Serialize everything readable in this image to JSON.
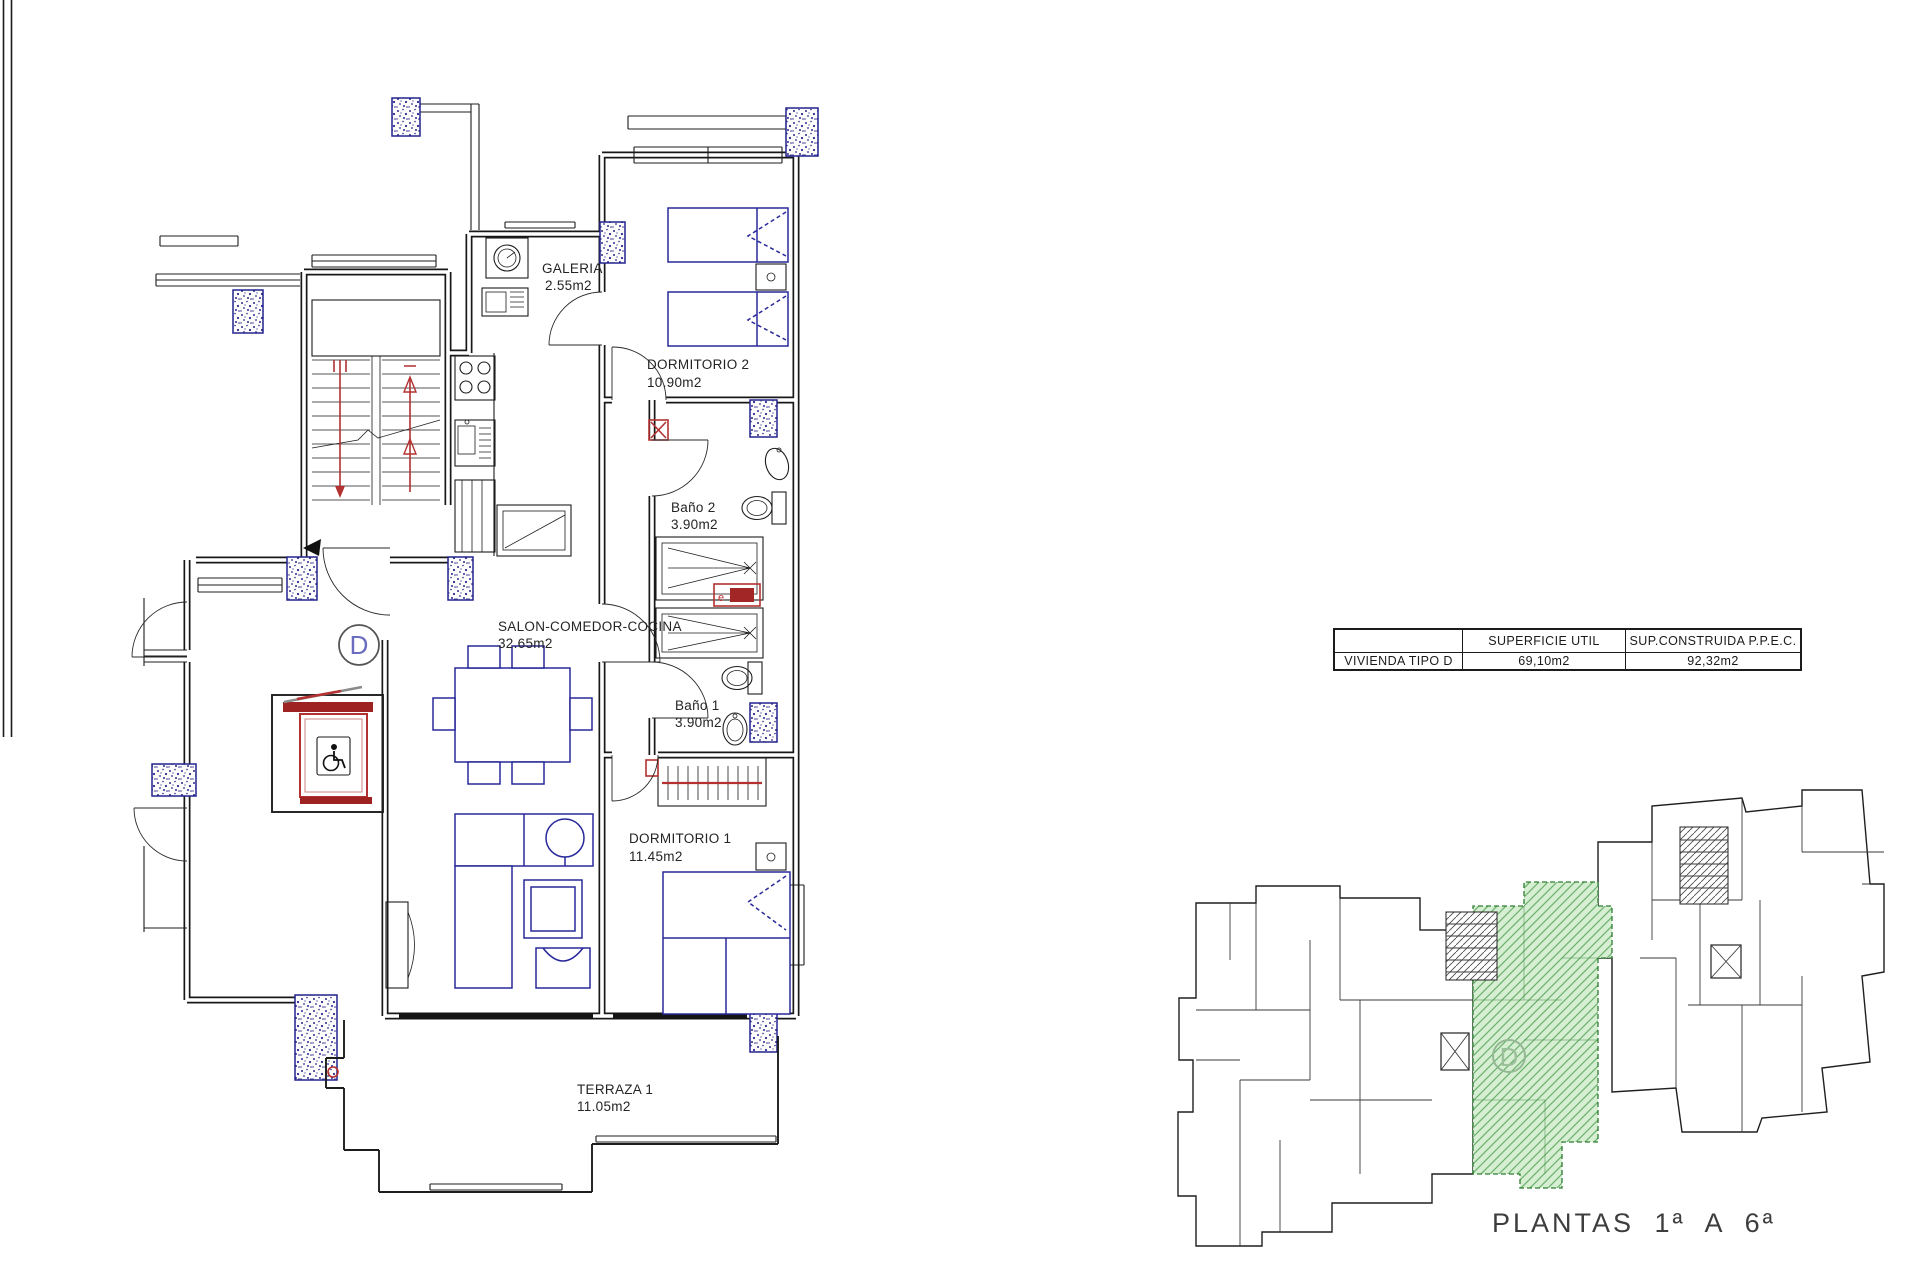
{
  "main_plan": {
    "unit_badge": "D",
    "heater_label": "e",
    "rooms": {
      "galeria": {
        "name": "GALERIA",
        "area": "2.55m2"
      },
      "dormitorio2": {
        "name": "DORMITORIO 2",
        "area": "10.90m2"
      },
      "bano2": {
        "name": "Baño 2",
        "area": "3.90m2"
      },
      "salon": {
        "name": "SALON-COMEDOR-COCINA",
        "area": "32.65m2"
      },
      "bano1": {
        "name": "Baño 1",
        "area": "3.90m2"
      },
      "dormitorio1": {
        "name": "DORMITORIO 1",
        "area": "11.45m2"
      },
      "terraza": {
        "name": "TERRAZA 1",
        "area": "11.05m2"
      }
    }
  },
  "summary_table": {
    "headers": {
      "col1": "",
      "col2": "SUPERFICIE UTIL",
      "col3": "SUP.CONSTRUIDA P.P.E.C."
    },
    "row": {
      "label": "VIVIENDA TIPO D",
      "superficie_util": "69,10m2",
      "sup_construida": "92,32m2"
    }
  },
  "overview_plan": {
    "unit_badge": "D",
    "caption": "PLANTAS 1ª A 6ª"
  },
  "colors": {
    "wall": "#181818",
    "furniture_blue": "#28289a",
    "column_blue": "#23238d",
    "accent_red": "#b43131",
    "elevator_red": "#9e2222",
    "highlight_green_fill": "#d6eed2",
    "highlight_green_line": "#6cb06c",
    "highlight_green_border": "#2e7d32",
    "text": "#242424"
  }
}
